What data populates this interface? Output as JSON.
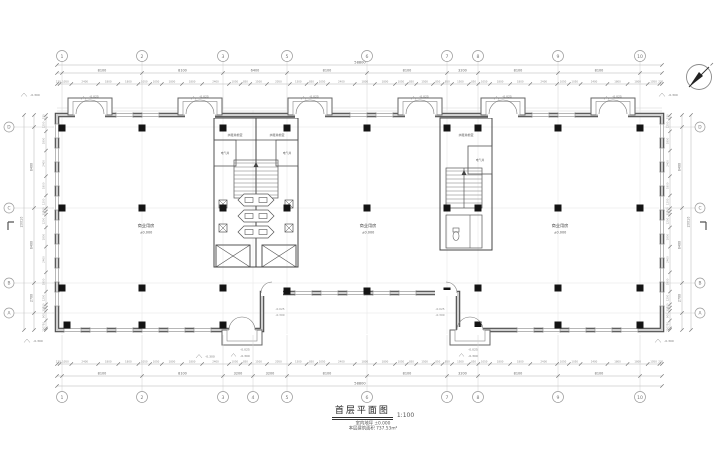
{
  "title_block": {
    "title": "首层平面图",
    "scale": "1:100",
    "note_level": "室内地坪 ±0.000",
    "note_area": "本层建筑面积 737.53m²"
  },
  "grid": {
    "top_labels": [
      "1",
      "2",
      "3",
      "5",
      "6",
      "7",
      "8",
      "9",
      "10"
    ],
    "bottom_labels": [
      "1",
      "2",
      "3",
      "4",
      "5",
      "6",
      "7",
      "8",
      "9",
      "10"
    ],
    "left_labels": [
      "D",
      "C",
      "B",
      "A"
    ],
    "right_labels": [
      "D",
      "C",
      "B",
      "A"
    ]
  },
  "dimensions": {
    "overall_width": "58800",
    "overall_height": "20010",
    "top_major": [
      "8100",
      "8100",
      "6400",
      "8100",
      "8100",
      "3200",
      "8100",
      "8100"
    ],
    "bottom_major": [
      "8100",
      "8100",
      "3200",
      "3200",
      "8100",
      "8100",
      "3200",
      "8100",
      "8100"
    ],
    "side_major": [
      "8400",
      "8400",
      "2700"
    ],
    "fine_top": [
      "230",
      "1050",
      "2400",
      "1800",
      "1800",
      "1050",
      "1050",
      "1800",
      "1800",
      "2400",
      "1050",
      "850",
      "1500",
      "2050",
      "1500",
      "850",
      "1050",
      "2400",
      "1800",
      "1800",
      "1050",
      "850",
      "1500",
      "850",
      "850",
      "1500",
      "850",
      "1050",
      "1800",
      "1800",
      "2400",
      "1050",
      "1050",
      "2400",
      "1800",
      "1800",
      "1050",
      "230"
    ],
    "fine_side": [
      "330",
      "1200",
      "1800",
      "2400",
      "1800",
      "1200",
      "300",
      "300",
      "1200",
      "1800",
      "2400",
      "1800",
      "1200",
      "300",
      "300",
      "900",
      "750",
      "150"
    ]
  },
  "levels": {
    "minus300": "-0.300",
    "minus025": "-0.025",
    "zero": "±0.000"
  },
  "rooms": {
    "retail_label": "商业用房",
    "retail_level": "±0.000",
    "lobby_label": "水暖井前室",
    "electrical_shaft_label": "电气井"
  }
}
